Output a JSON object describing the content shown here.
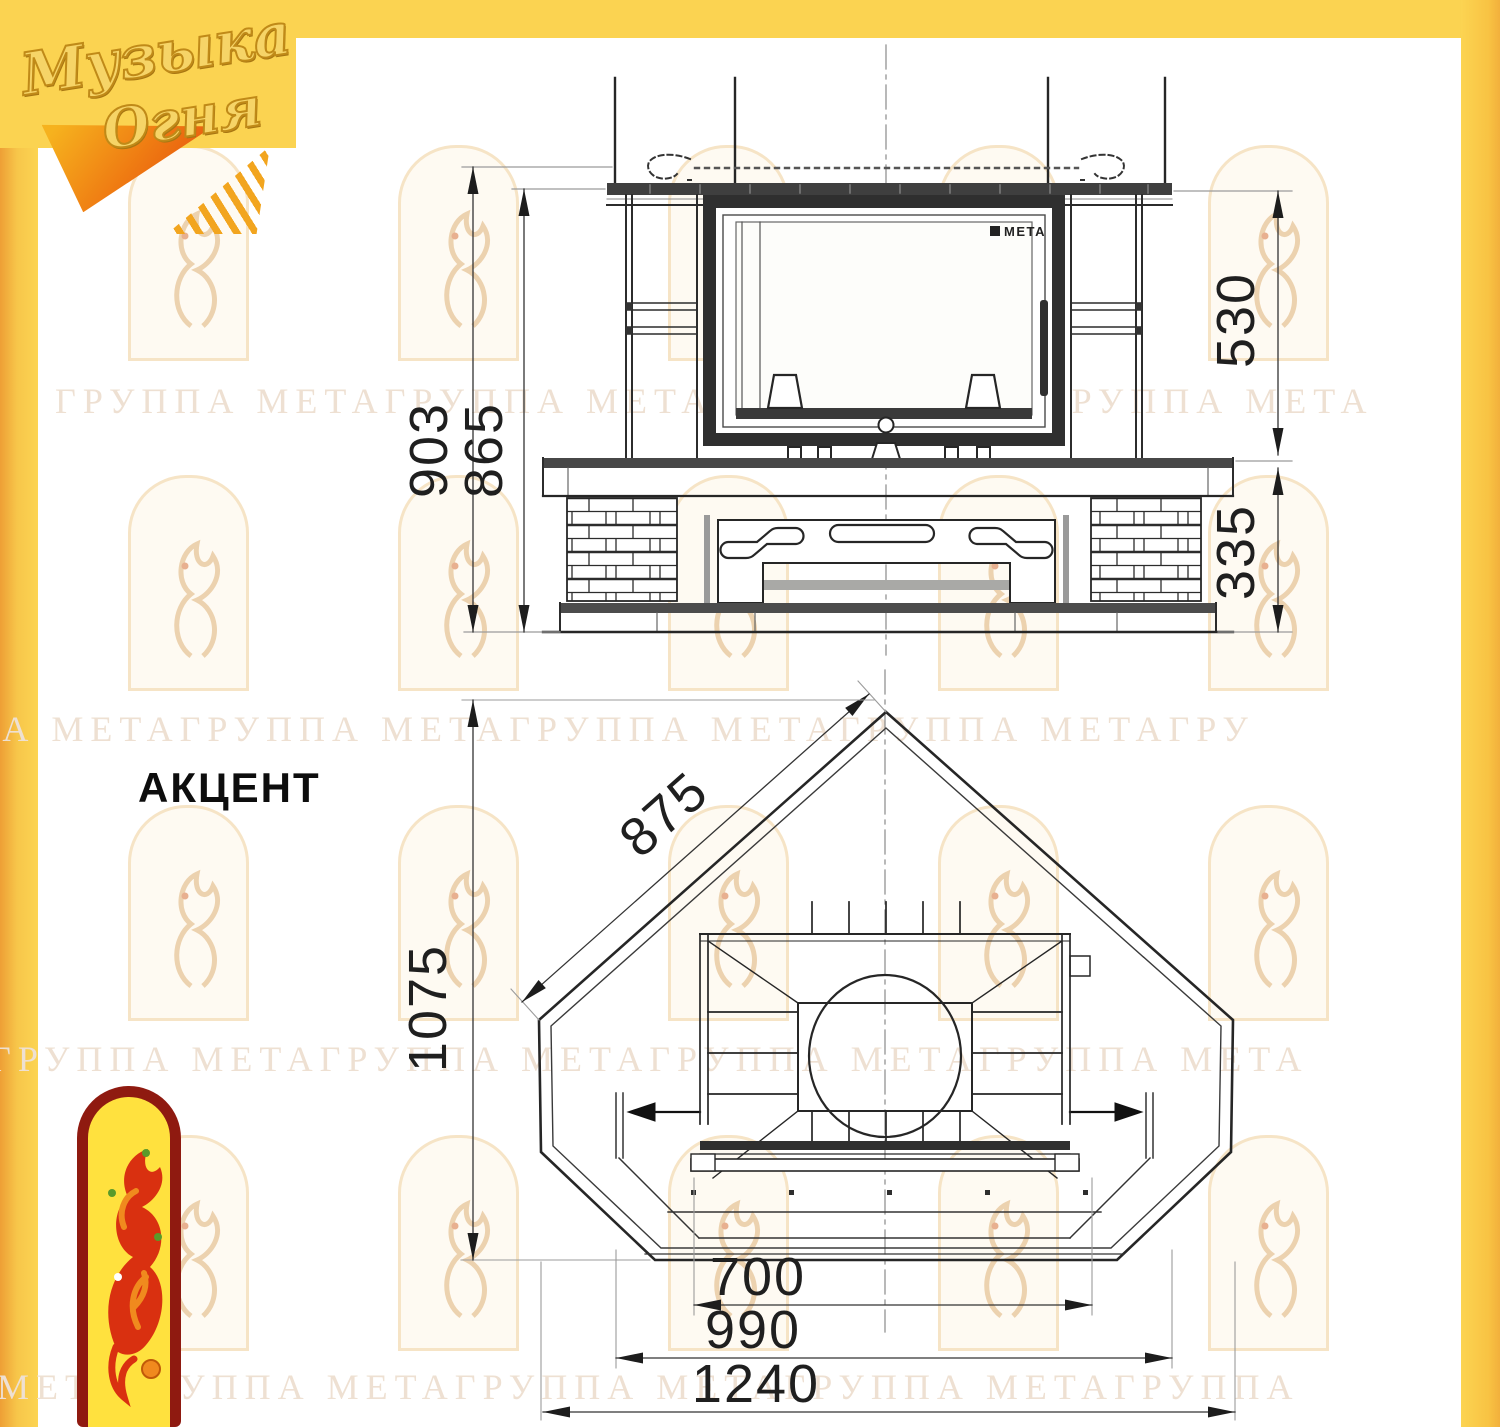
{
  "page_title": "АКЦЕНТ",
  "brand_logo": {
    "line1": "Музыка",
    "line2": "Огня"
  },
  "watermark": {
    "rows": [
      "ГРУППА МЕТАГРУППА МЕТАГРУППА МЕТАГРУППА МЕТА",
      "ГРУППА МЕТАГРУППА МЕТАГРУППА МЕТАГРУППА МЕТАГРУ",
      "ГРУППА МЕТАГРУППА МЕТАГРУППА МЕТАГРУППА МЕТА",
      "ПА МЕТАГРУППА МЕТАГРУППА МЕТАГРУППА МЕТАГРУППА"
    ]
  },
  "front_view": {
    "dims": {
      "total_height": "903",
      "portal_height": "865",
      "firebox_height": "530",
      "base_height": "335"
    },
    "insert_brand": "МЕТА"
  },
  "plan_view": {
    "dims": {
      "side": "875",
      "depth": "1075",
      "firebox_width": "700",
      "inner_width": "990",
      "overall_width": "1240"
    }
  },
  "colors": {
    "accent_yellow": "#fbd351",
    "accent_orange": "#ee9f35",
    "logo_red": "#8f1a10",
    "logo_yellow": "#ffe13e",
    "watermark_text": "#eee0d2",
    "line": "#262626"
  }
}
